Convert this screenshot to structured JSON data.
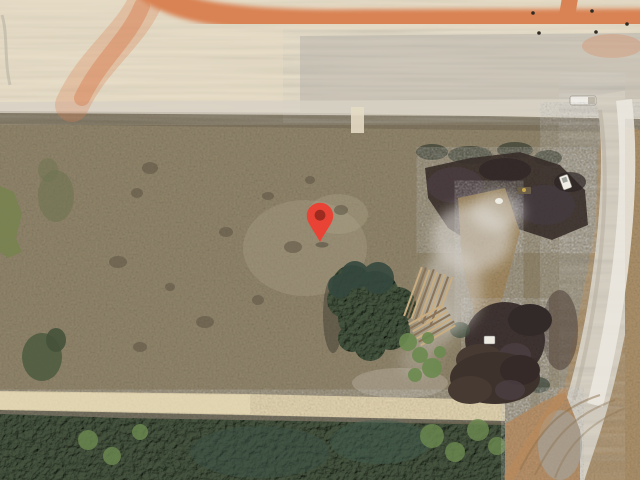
{
  "view": {
    "type": "satellite-imagery",
    "width_px": 640,
    "height_px": 480,
    "features": [
      "graded-construction-area-north",
      "orange-dirt-haul-road",
      "cleared-scrub-parcel",
      "tree-cluster-center",
      "felled-log-piles",
      "burn-soil-piles-east",
      "smoke-ash-plume",
      "access-road-strip-east",
      "sand-track-south",
      "tree-canopy-south",
      "cleared-corner-southeast"
    ]
  },
  "marker": {
    "name": "dropped-pin",
    "tip_x": 320,
    "tip_y": 242,
    "color": "#E84335",
    "dot_color": "#9E2B20"
  },
  "palette": {
    "graded_dirt": "#E9DFC9",
    "graded_gray": "#C8C3B8",
    "orange_road": "#D98253",
    "scrub": "#92866C",
    "sand_track": "#E2D4B0",
    "trees_dark": "#46543F",
    "trees_mid": "#44543E",
    "green_light": "#6C8A50",
    "burn_pile": "#3F3430",
    "burn_purple": "#4E4046",
    "smoke": "#D9D6D0",
    "access_road": "#D8D2C5",
    "access_core": "#ECE9E1",
    "right_tan": "#B2946B",
    "cleared_tan": "#B8926A",
    "log_tan": "#C9AD80"
  }
}
